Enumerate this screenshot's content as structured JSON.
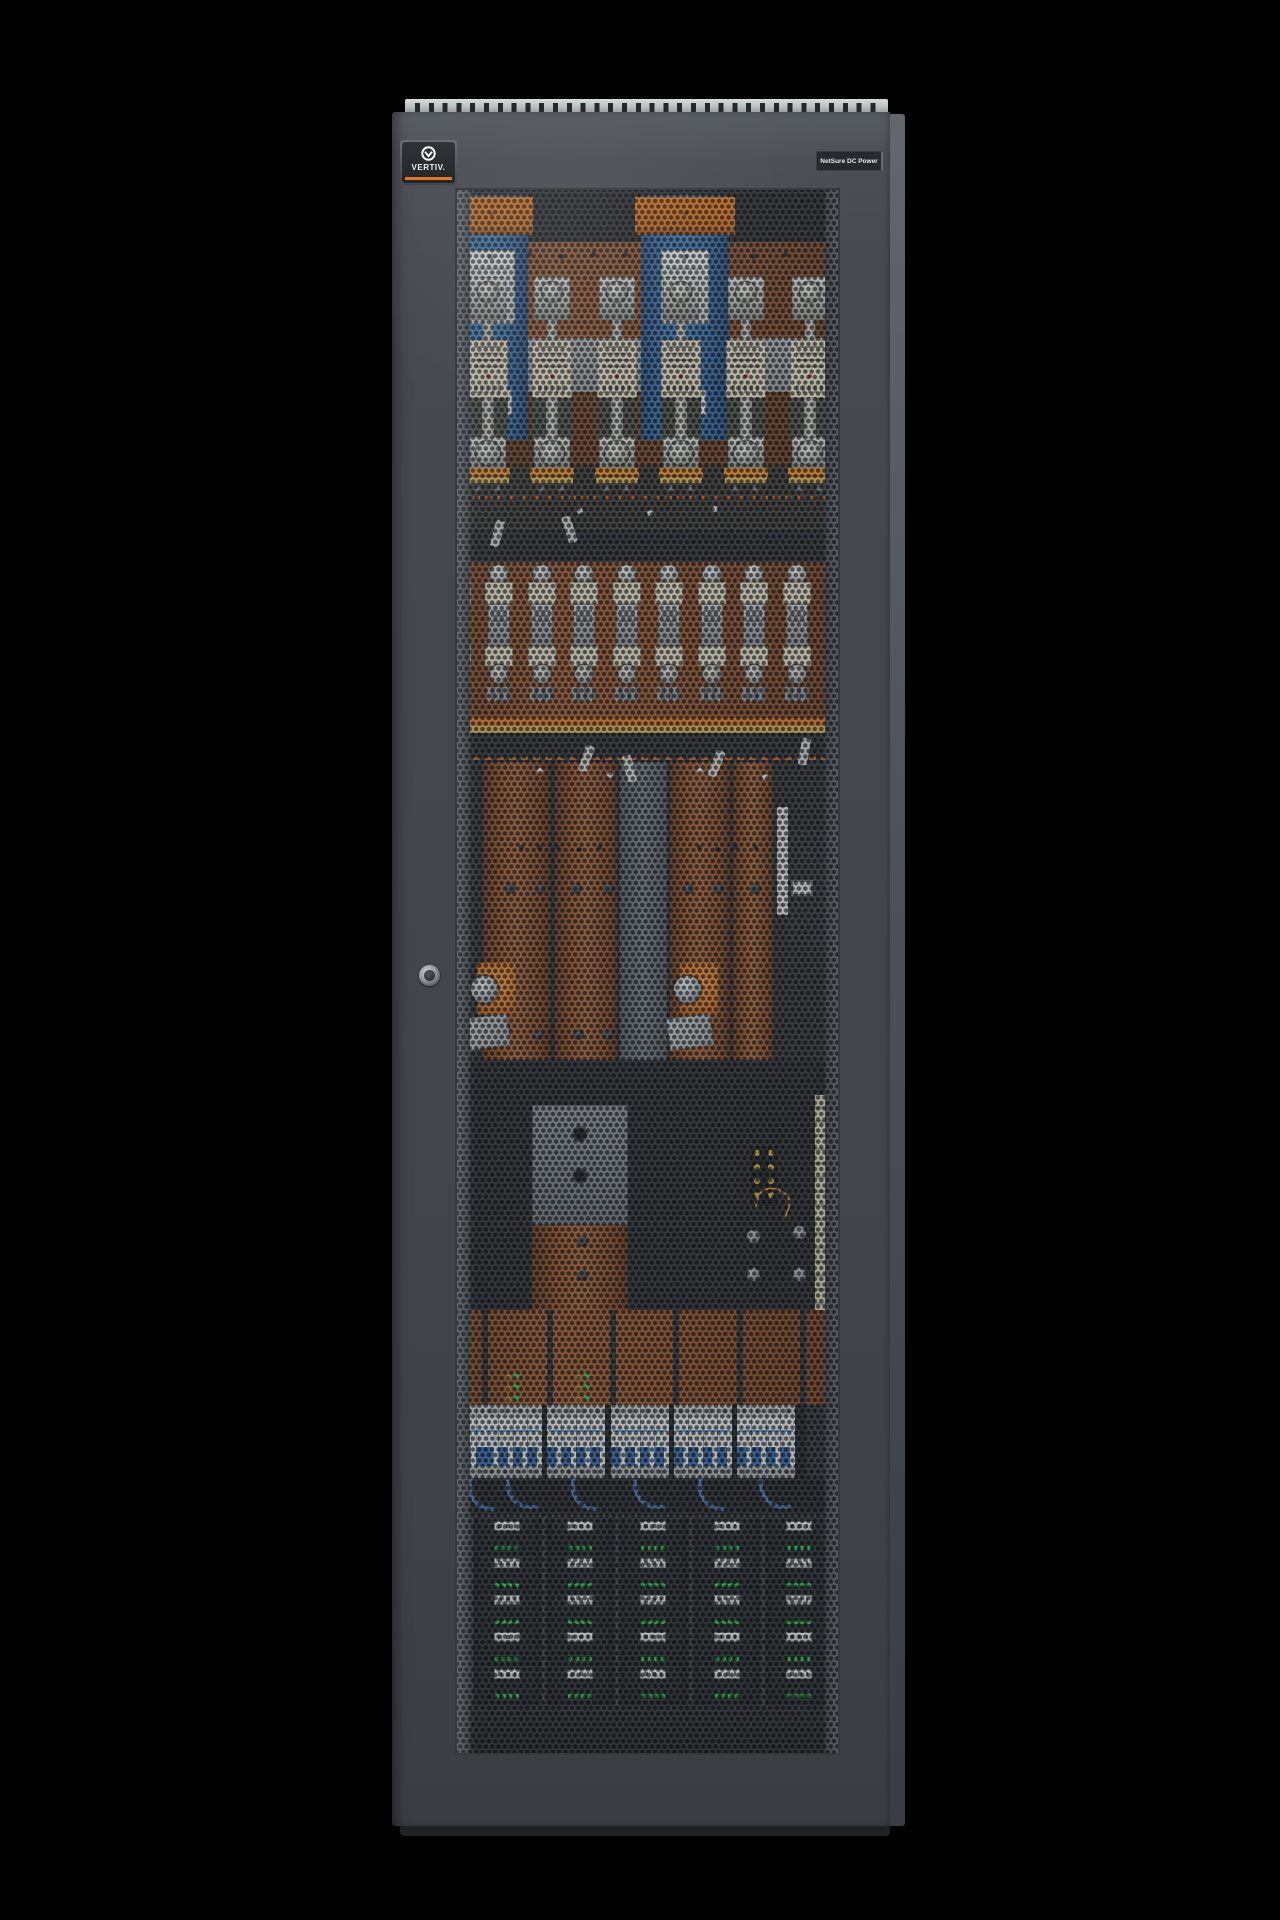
{
  "scene": {
    "background_color": "#000000",
    "description": "Front view of a dark gray telecom DC power cabinet with a perforated hex-mesh door revealing fuses, copper busbars, shunts, breakers and rectifier shelves"
  },
  "cabinet": {
    "brand_badge": {
      "text": "VERTIV.",
      "accent_color": "#E8731A",
      "logo_icon": "vertiv-circle-v"
    },
    "model_badge": {
      "text": "NetSure DC Power"
    },
    "door": {
      "color": "#43474D",
      "mesh_hole_color": "#101214",
      "lock": "keyed-round-lock"
    },
    "top_rail": {
      "hole_count": 34,
      "color": "#B9BEBD"
    }
  },
  "equipment": {
    "nh_fuse_row": {
      "count": 6,
      "body_color": "#DED7BF",
      "terminal_color": "#E0841F"
    },
    "distribution_fuse_row": {
      "count": 10,
      "body_color": "#D8D2BA"
    },
    "busbars": {
      "color": "#8F4C22",
      "columns": 5
    },
    "battery_terminals": {
      "count": 2,
      "pad_color": "#C76A1E"
    },
    "shunt_assemblies": {
      "count": 2,
      "frame_color": "#2E6AA8",
      "cap_color": "#D96F17"
    },
    "terminal_strip": {
      "dot_color": "#C9A233",
      "dot_rows": 4,
      "dot_cols": 2
    },
    "indicator_clusters": {
      "count": 2,
      "green": "#35B54A",
      "yellow": "#D1A62C"
    },
    "breaker_row": {
      "group_count": 6,
      "body_color": "#D4D7D9",
      "toggle_color": "#2B5E9C"
    },
    "rectifier_shelf": {
      "columns": 5,
      "rows": 5,
      "handle_color": "#DFE2E3",
      "led_color": "#33B34C",
      "leds_per_module": 4
    }
  }
}
